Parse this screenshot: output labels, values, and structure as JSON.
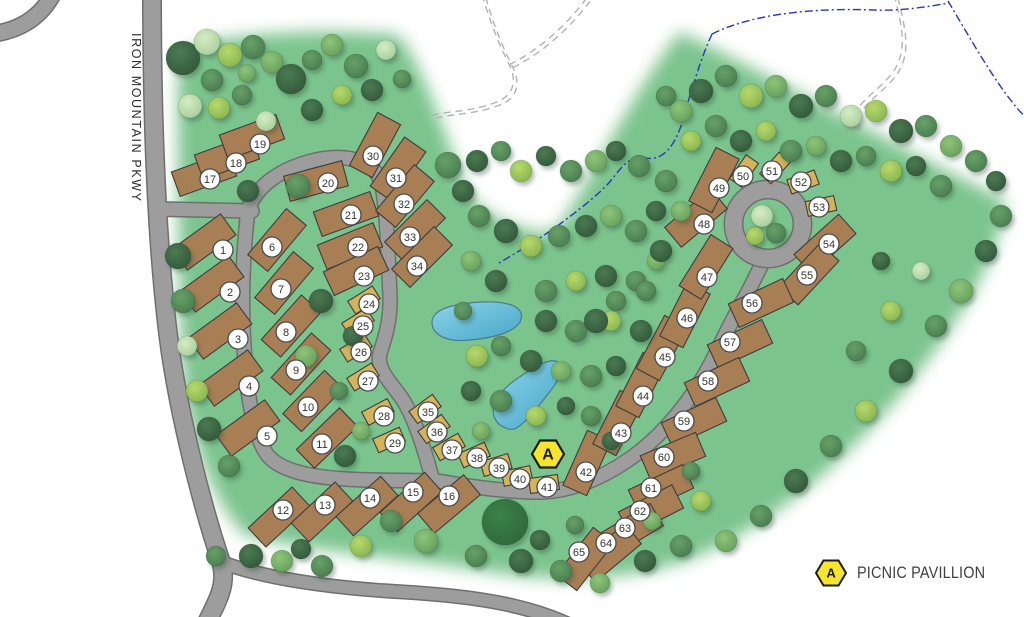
{
  "map": {
    "road_label": "IRON MOUNTAIN PKWY",
    "legend": {
      "marker_letter": "A",
      "label": "PICNIC PAVILLION"
    },
    "pavilion_marker": {
      "letter": "A",
      "x": 548,
      "y": 454
    },
    "colors": {
      "grass": "#7cc48e",
      "road_fill": "#9d9d9d",
      "road_edge": "#6f6f6f",
      "rv_site": "#a87e54",
      "tent_site": "#d4b35c",
      "site_border": "#3c3c3c",
      "pond_light": "#8ed4e8",
      "pond_deep": "#45a6c9",
      "pond_edge": "#4a7b8a",
      "stream": "#2a35c0",
      "trail": "#b3b3b3",
      "marker_yellow": "#f6e52e",
      "badge_fill": "#ffffff",
      "badge_edge": "#4a4a4a",
      "badge_text": "#333333"
    },
    "sites": [
      {
        "n": 1,
        "x": 204,
        "y": 242,
        "a": -36,
        "t": "rv",
        "bx": 223,
        "by": 250
      },
      {
        "n": 2,
        "x": 212,
        "y": 284,
        "a": -36,
        "t": "rv",
        "bx": 230,
        "by": 292
      },
      {
        "n": 3,
        "x": 220,
        "y": 331,
        "a": -36,
        "t": "rv",
        "bx": 238,
        "by": 339
      },
      {
        "n": 4,
        "x": 231,
        "y": 378,
        "a": -36,
        "t": "rv",
        "bx": 249,
        "by": 386
      },
      {
        "n": 5,
        "x": 248,
        "y": 428,
        "a": -36,
        "t": "rv",
        "bx": 267,
        "by": 436
      },
      {
        "n": 6,
        "x": 277,
        "y": 240,
        "a": -50,
        "t": "rv",
        "bx": 272,
        "by": 247
      },
      {
        "n": 7,
        "x": 284,
        "y": 283,
        "a": -50,
        "t": "rv",
        "bx": 281,
        "by": 289
      },
      {
        "n": 8,
        "x": 291,
        "y": 326,
        "a": -48,
        "t": "rv",
        "bx": 286,
        "by": 332
      },
      {
        "n": 9,
        "x": 301,
        "y": 364,
        "a": -48,
        "t": "rv",
        "bx": 296,
        "by": 370
      },
      {
        "n": 10,
        "x": 313,
        "y": 401,
        "a": -46,
        "t": "rv",
        "bx": 308,
        "by": 407
      },
      {
        "n": 11,
        "x": 327,
        "y": 438,
        "a": -44,
        "t": "rv",
        "bx": 322,
        "by": 444
      },
      {
        "n": 12,
        "x": 279,
        "y": 517,
        "a": -43,
        "t": "rv",
        "bx": 283,
        "by": 510
      },
      {
        "n": 13,
        "x": 322,
        "y": 512,
        "a": -43,
        "t": "rv",
        "bx": 325,
        "by": 505
      },
      {
        "n": 14,
        "x": 367,
        "y": 506,
        "a": -42,
        "t": "rv",
        "bx": 370,
        "by": 498
      },
      {
        "n": 15,
        "x": 411,
        "y": 502,
        "a": -42,
        "t": "rv",
        "bx": 413,
        "by": 492
      },
      {
        "n": 16,
        "x": 449,
        "y": 504,
        "a": -40,
        "t": "rv",
        "bx": 449,
        "by": 496
      },
      {
        "n": 17,
        "x": 204,
        "y": 174,
        "a": -20,
        "t": "rv",
        "bx": 210,
        "by": 179
      },
      {
        "n": 18,
        "x": 227,
        "y": 157,
        "a": -20,
        "t": "rv",
        "bx": 236,
        "by": 163
      },
      {
        "n": 19,
        "x": 252,
        "y": 137,
        "a": -20,
        "t": "rv",
        "bx": 260,
        "by": 144
      },
      {
        "n": 20,
        "x": 316,
        "y": 181,
        "a": -15,
        "t": "rv",
        "bx": 328,
        "by": 183
      },
      {
        "n": 21,
        "x": 346,
        "y": 214,
        "a": -20,
        "t": "rv",
        "bx": 351,
        "by": 215
      },
      {
        "n": 22,
        "x": 350,
        "y": 246,
        "a": -22,
        "t": "rv",
        "bx": 358,
        "by": 247
      },
      {
        "n": 23,
        "x": 356,
        "y": 271,
        "a": -25,
        "t": "rv",
        "bx": 364,
        "by": 276
      },
      {
        "n": 24,
        "x": 364,
        "y": 300,
        "a": -32,
        "t": "tent",
        "bx": 369,
        "by": 304
      },
      {
        "n": 25,
        "x": 358,
        "y": 322,
        "a": -32,
        "t": "tent",
        "bx": 363,
        "by": 326
      },
      {
        "n": 26,
        "x": 356,
        "y": 348,
        "a": -32,
        "t": "tent",
        "bx": 361,
        "by": 352
      },
      {
        "n": 27,
        "x": 363,
        "y": 377,
        "a": -32,
        "t": "tent",
        "bx": 368,
        "by": 381
      },
      {
        "n": 28,
        "x": 378,
        "y": 412,
        "a": -28,
        "t": "tent",
        "bx": 384,
        "by": 416
      },
      {
        "n": 29,
        "x": 389,
        "y": 440,
        "a": -24,
        "t": "tent",
        "bx": 395,
        "by": 443
      },
      {
        "n": 30,
        "x": 375,
        "y": 145,
        "a": -62,
        "t": "rv",
        "bx": 373,
        "by": 156
      },
      {
        "n": 31,
        "x": 398,
        "y": 169,
        "a": -55,
        "t": "rv",
        "bx": 396,
        "by": 178
      },
      {
        "n": 32,
        "x": 405,
        "y": 196,
        "a": -50,
        "t": "rv",
        "bx": 404,
        "by": 204
      },
      {
        "n": 33,
        "x": 415,
        "y": 230,
        "a": -45,
        "t": "rv",
        "bx": 410,
        "by": 237
      },
      {
        "n": 34,
        "x": 422,
        "y": 257,
        "a": -45,
        "t": "rv",
        "bx": 417,
        "by": 266
      },
      {
        "n": 35,
        "x": 425,
        "y": 409,
        "a": -36,
        "t": "tent",
        "bx": 428,
        "by": 412
      },
      {
        "n": 36,
        "x": 434,
        "y": 429,
        "a": -36,
        "t": "tent",
        "bx": 437,
        "by": 432
      },
      {
        "n": 37,
        "x": 449,
        "y": 447,
        "a": -30,
        "t": "tent",
        "bx": 452,
        "by": 450
      },
      {
        "n": 38,
        "x": 474,
        "y": 455,
        "a": -24,
        "t": "tent",
        "bx": 477,
        "by": 458
      },
      {
        "n": 39,
        "x": 496,
        "y": 465,
        "a": -17,
        "t": "tent",
        "bx": 499,
        "by": 468
      },
      {
        "n": 40,
        "x": 517,
        "y": 476,
        "a": -12,
        "t": "tent",
        "bx": 520,
        "by": 479
      },
      {
        "n": 41,
        "x": 544,
        "y": 484,
        "a": -8,
        "t": "tent",
        "bx": 547,
        "by": 487
      },
      {
        "n": 42,
        "x": 587,
        "y": 463,
        "a": -66,
        "t": "rv",
        "bx": 586,
        "by": 472
      },
      {
        "n": 43,
        "x": 618,
        "y": 423,
        "a": -63,
        "t": "rv",
        "bx": 621,
        "by": 433
      },
      {
        "n": 44,
        "x": 641,
        "y": 385,
        "a": -63,
        "t": "rv",
        "bx": 643,
        "by": 396
      },
      {
        "n": 45,
        "x": 662,
        "y": 348,
        "a": -62,
        "t": "rv",
        "bx": 665,
        "by": 357
      },
      {
        "n": 46,
        "x": 685,
        "y": 315,
        "a": -63,
        "t": "rv",
        "bx": 687,
        "by": 318
      },
      {
        "n": 47,
        "x": 706,
        "y": 267,
        "a": -58,
        "t": "rv",
        "bx": 707,
        "by": 277
      },
      {
        "n": 48,
        "x": 696,
        "y": 218,
        "a": -40,
        "t": "rv",
        "bx": 704,
        "by": 224
      },
      {
        "n": 49,
        "x": 714,
        "y": 180,
        "a": -63,
        "t": "rv",
        "bx": 719,
        "by": 188
      },
      {
        "n": 50,
        "x": 744,
        "y": 171,
        "a": -55,
        "t": "tent",
        "bx": 743,
        "by": 176
      },
      {
        "n": 51,
        "x": 775,
        "y": 168,
        "a": -48,
        "t": "tent",
        "bx": 772,
        "by": 171
      },
      {
        "n": 52,
        "x": 803,
        "y": 182,
        "a": -20,
        "t": "tent",
        "bx": 801,
        "by": 182
      },
      {
        "n": 53,
        "x": 821,
        "y": 206,
        "a": -12,
        "t": "tent",
        "bx": 819,
        "by": 207
      },
      {
        "n": 54,
        "x": 825,
        "y": 244,
        "a": -42,
        "t": "rv",
        "bx": 829,
        "by": 244
      },
      {
        "n": 55,
        "x": 809,
        "y": 274,
        "a": -47,
        "t": "rv",
        "bx": 807,
        "by": 275
      },
      {
        "n": 56,
        "x": 761,
        "y": 303,
        "a": -25,
        "t": "rv",
        "bx": 752,
        "by": 303
      },
      {
        "n": 57,
        "x": 740,
        "y": 344,
        "a": -25,
        "t": "rv",
        "bx": 730,
        "by": 342
      },
      {
        "n": 58,
        "x": 717,
        "y": 382,
        "a": -25,
        "t": "rv",
        "bx": 708,
        "by": 381
      },
      {
        "n": 59,
        "x": 694,
        "y": 422,
        "a": -25,
        "t": "rv",
        "bx": 684,
        "by": 421
      },
      {
        "n": 60,
        "x": 673,
        "y": 456,
        "a": -23,
        "t": "rv",
        "bx": 664,
        "by": 457
      },
      {
        "n": 61,
        "x": 661,
        "y": 489,
        "a": -25,
        "t": "rv",
        "bx": 651,
        "by": 488
      },
      {
        "n": 62,
        "x": 651,
        "y": 510,
        "a": -27,
        "t": "rv",
        "bx": 640,
        "by": 511
      },
      {
        "n": 63,
        "x": 631,
        "y": 530,
        "a": -31,
        "t": "rv",
        "bx": 625,
        "by": 528
      },
      {
        "n": 64,
        "x": 610,
        "y": 553,
        "a": -40,
        "t": "rv",
        "bx": 606,
        "by": 543
      },
      {
        "n": 65,
        "x": 585,
        "y": 559,
        "a": -52,
        "t": "rv",
        "bx": 579,
        "by": 552
      }
    ]
  }
}
